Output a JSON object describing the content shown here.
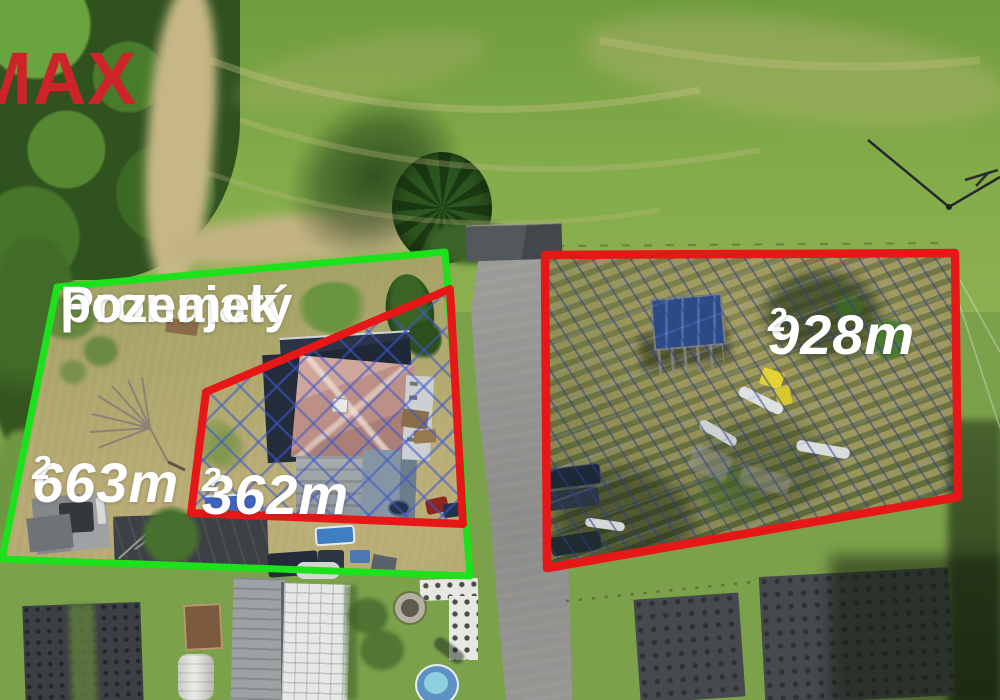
{
  "logo": {
    "text": "MAX",
    "color": "#cd2429"
  },
  "annotations": {
    "title": {
      "line1": "Pronajatý",
      "line2": "pozemek"
    },
    "areas": {
      "left": {
        "text": "663m",
        "sup": "2"
      },
      "middle": {
        "text": "362m",
        "sup": "2"
      },
      "right": {
        "text": "928m",
        "sup": "2"
      }
    },
    "outline_colors": {
      "leased_green": "#1be21b",
      "sale_red": "#e81717",
      "hatch_blue": "#3e58cd"
    },
    "polygons": {
      "green_points": "57,287 445,252 470,576 2,559",
      "red_mid_points": "450,289 206,392 191,513 463,524",
      "red_right_points": "545,255 955,253 958,497 547,568"
    }
  }
}
